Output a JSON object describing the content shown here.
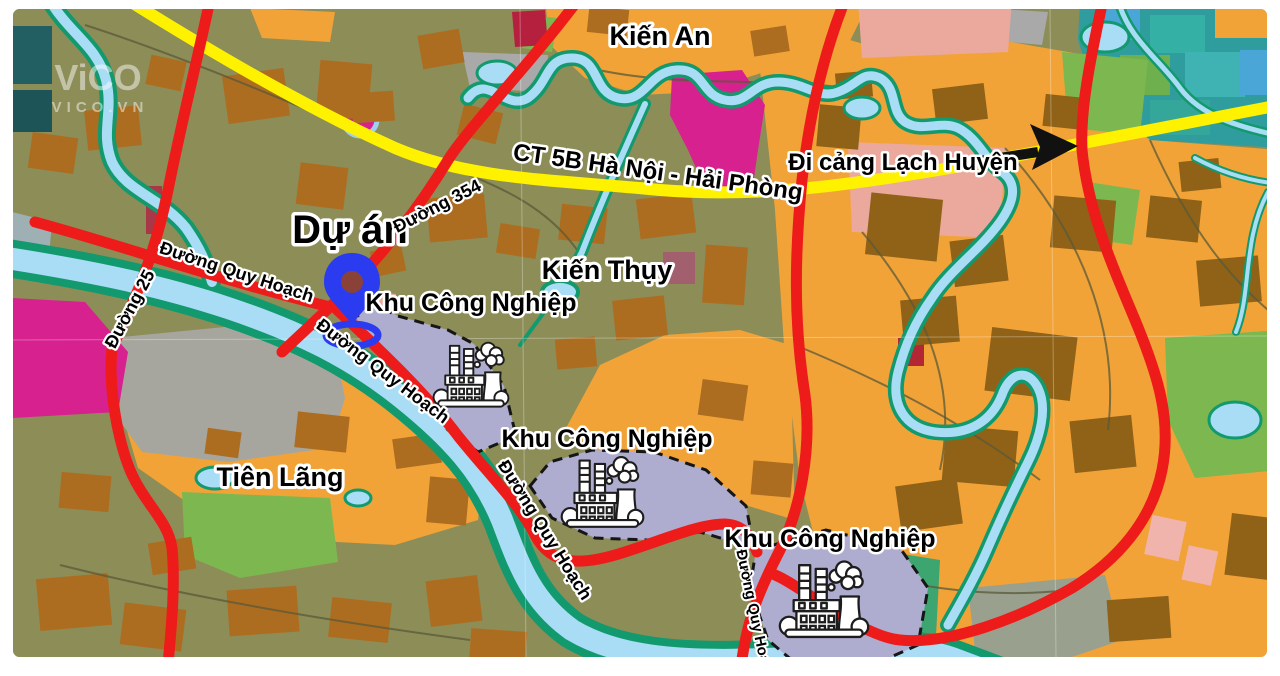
{
  "watermark": {
    "brand": "ViCO",
    "domain": "VICO.VN"
  },
  "labels": {
    "kien_an": "Kiến An",
    "kien_thuy": "Kiến Thụy",
    "tien_lang": "Tiên Lãng",
    "project": "Dự án",
    "highway": "CT 5B Hà Nội - Hải Phòng",
    "port_direction": "Đi cảng Lạch Huyện",
    "road_354": "Đường 354",
    "road_25": "Đường 25",
    "planned_road": "Đường Quy Hoạch",
    "industrial_park": "Khu Công Nghiệp"
  },
  "icons": {
    "project_marker": "location-pin",
    "industrial_park": "factory",
    "port_direction": "right-arrow"
  },
  "colors": {
    "land_olive": "#8d8d58",
    "land_orange": "#f2a338",
    "parcel_brown": "#ad6d20",
    "river_water": "#a9dcf5",
    "river_bank": "#12996d",
    "road_red": "#ee1b1b",
    "highway_yellow": "#fef200",
    "industrial_lavender": "#aeadcf",
    "zone_magenta": "#d6218f",
    "zone_salmon": "#eba89d",
    "zone_gray": "#a6a69e",
    "zone_green": "#7cb84f",
    "pin_blue": "#2b3cf0"
  }
}
